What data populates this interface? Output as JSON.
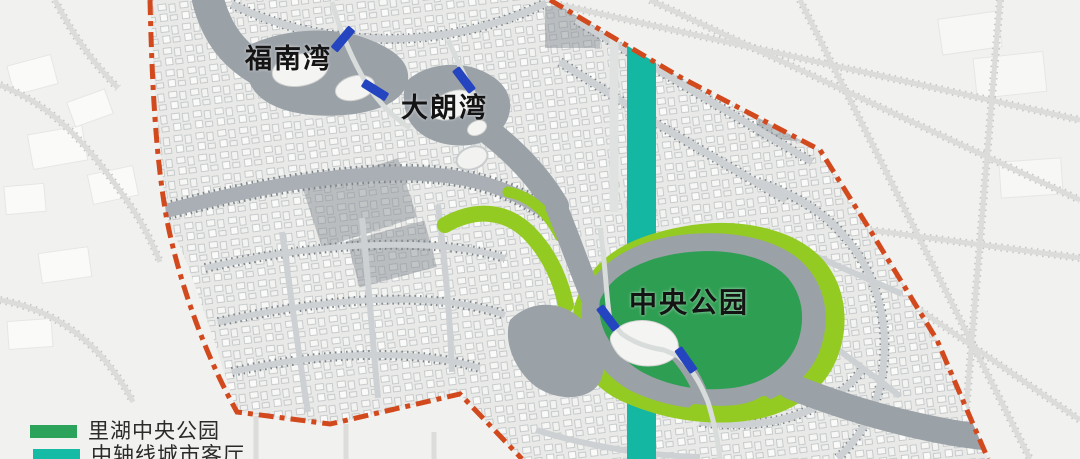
{
  "map_labels": {
    "funan_bay": "福南湾",
    "dalang_bay": "大朗湾",
    "central_park": "中央公园"
  },
  "legend": {
    "items": [
      {
        "label": "里湖中央公园",
        "color": "#2ba35a"
      },
      {
        "label": "中轴线城市客厅",
        "color": "#16bba6"
      }
    ]
  },
  "colors": {
    "outside_base": "#f1f1ef",
    "land_base": "#e9eae8",
    "boundary_red": "#d2491d",
    "axis_teal": "#14b8a2",
    "park_green": "#2e9e52",
    "corridor_green": "#94cb22",
    "water_gray": "#9aa1a7",
    "bridge_blue": "#2444c0",
    "road_light": "#cdd1d3",
    "tree_dot": "#7c848a"
  }
}
